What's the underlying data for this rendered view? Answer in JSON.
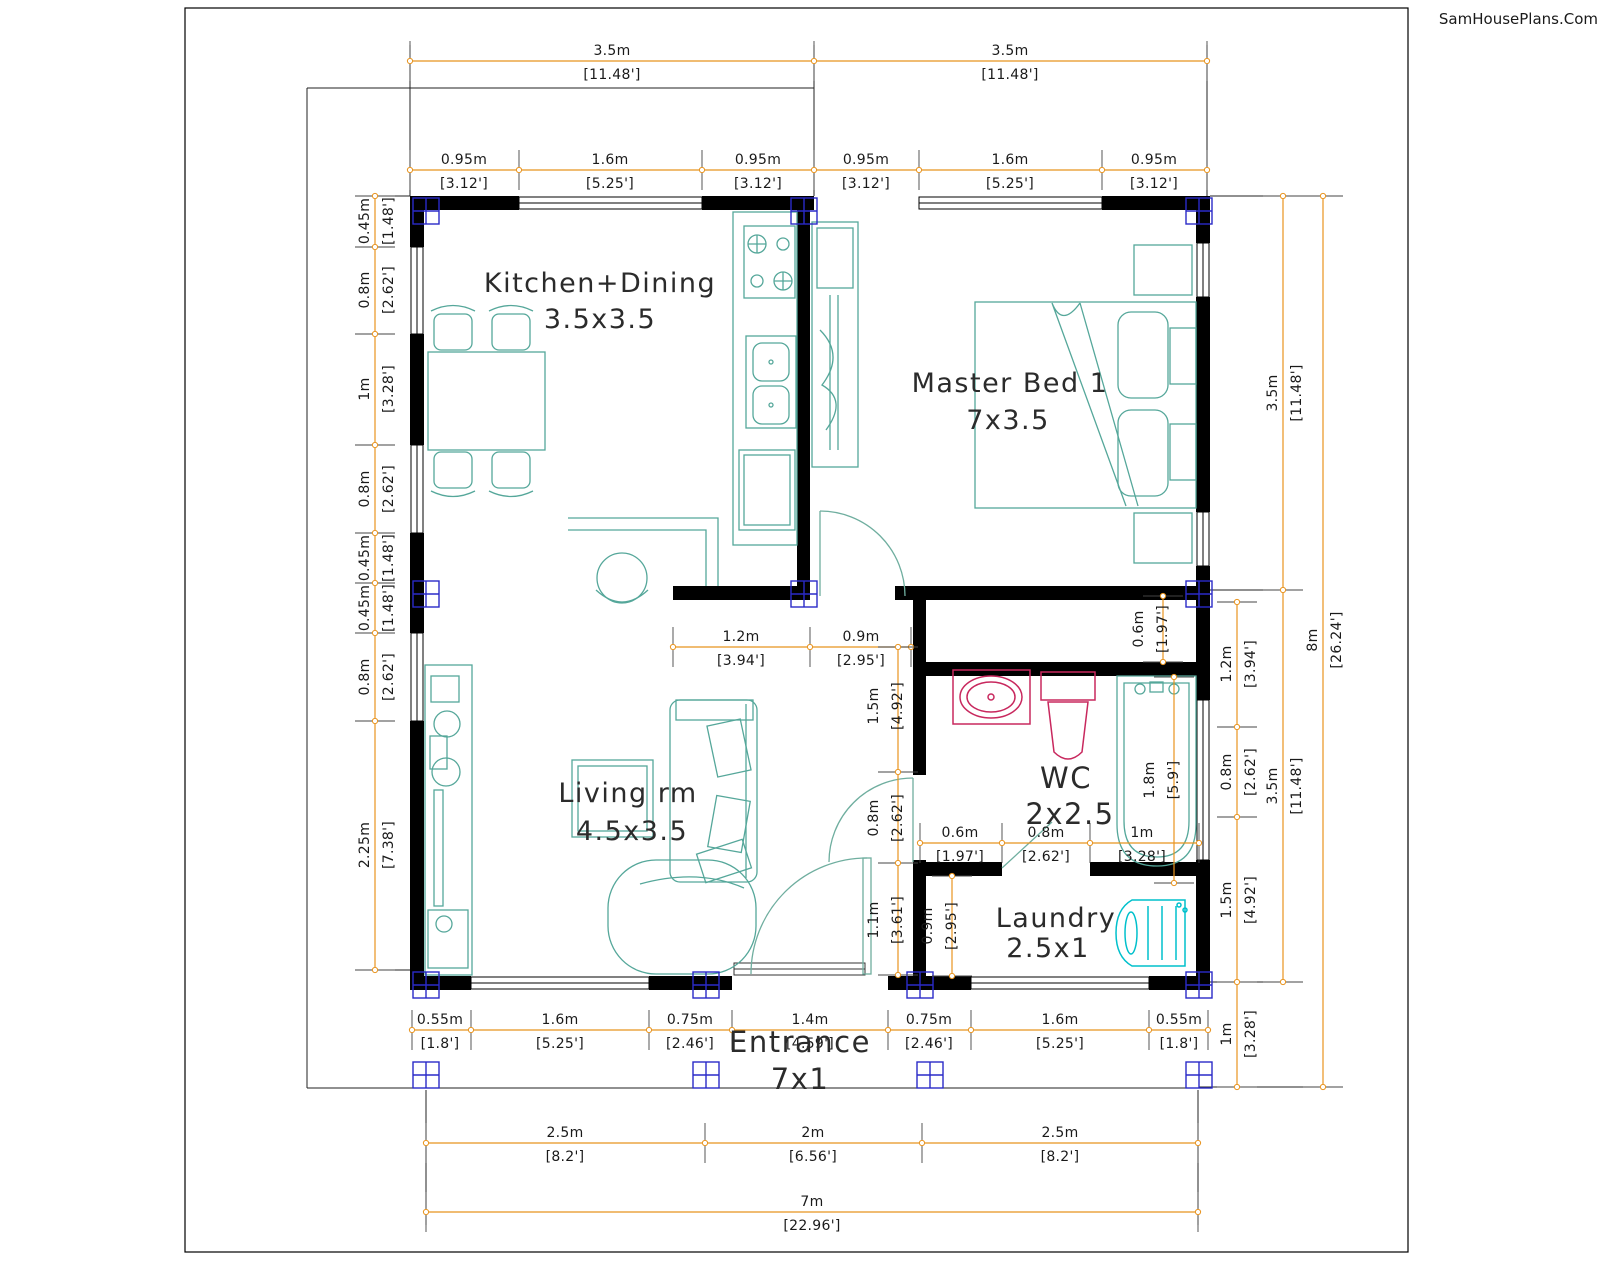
{
  "watermark": "SamHousePlans.Com",
  "colors": {
    "dim_line": "#E8941F",
    "wall": "#000000",
    "furniture": "#55A79A",
    "sanitary": "#C8285E",
    "washer": "#00C0CC",
    "column": "#2A2AC8",
    "tick": "#444444"
  },
  "rooms": [
    {
      "label": "Kitchen+Dining",
      "size": "3.5x3.5",
      "x": 600,
      "y": 292,
      "sx": 600,
      "sy": 328,
      "fs": 27
    },
    {
      "label": "Master Bed 1",
      "size": "7x3.5",
      "x": 1010,
      "y": 392,
      "sx": 1008,
      "sy": 429,
      "fs": 27
    },
    {
      "label": "Living rm",
      "size": "4.5x3.5",
      "x": 628,
      "y": 802,
      "sx": 632,
      "sy": 840,
      "fs": 27
    },
    {
      "label": "WC",
      "size": "2x2.5",
      "x": 1066,
      "y": 788,
      "sx": 1070,
      "sy": 824,
      "fs": 29
    },
    {
      "label": "Laundry",
      "size": "2.5x1",
      "x": 1056,
      "y": 927,
      "sx": 1048,
      "sy": 957,
      "fs": 27
    },
    {
      "label": "Entrance",
      "size": "7x1",
      "x": 800,
      "y": 1052,
      "sx": 800,
      "sy": 1089,
      "fs": 29
    }
  ],
  "dim_lines": [
    {
      "o": "h",
      "pos": 61,
      "from": 410,
      "to": 1207,
      "ticks": [
        410,
        814,
        1207
      ],
      "labels": [
        {
          "m": "3.5m",
          "ft": "[11.48']",
          "at": 612
        },
        {
          "m": "3.5m",
          "ft": "[11.48']",
          "at": 1010
        }
      ]
    },
    {
      "o": "h",
      "pos": 170,
      "from": 410,
      "to": 1207,
      "ticks": [
        410,
        519,
        702,
        814,
        919,
        1102,
        1207
      ],
      "labels": [
        {
          "m": "0.95m",
          "ft": "[3.12']",
          "at": 464
        },
        {
          "m": "1.6m",
          "ft": "[5.25']",
          "at": 610
        },
        {
          "m": "0.95m",
          "ft": "[3.12']",
          "at": 758
        },
        {
          "m": "0.95m",
          "ft": "[3.12']",
          "at": 866
        },
        {
          "m": "1.6m",
          "ft": "[5.25']",
          "at": 1010
        },
        {
          "m": "0.95m",
          "ft": "[3.12']",
          "at": 1154
        }
      ]
    },
    {
      "o": "h",
      "pos": 647,
      "from": 673,
      "to": 911,
      "ticks": [
        673,
        810,
        911
      ],
      "labels": [
        {
          "m": "1.2m",
          "ft": "[3.94']",
          "at": 741
        },
        {
          "m": "0.9m",
          "ft": "[2.95']",
          "at": 861
        }
      ]
    },
    {
      "o": "h",
      "pos": 843,
      "from": 920,
      "to": 1199,
      "ticks": [
        920,
        1002,
        1090,
        1199
      ],
      "labels": [
        {
          "m": "0.6m",
          "ft": "[1.97']",
          "at": 960
        },
        {
          "m": "0.8m",
          "ft": "[2.62']",
          "at": 1046
        },
        {
          "m": "1m",
          "ft": "[3.28']",
          "at": 1142
        }
      ]
    },
    {
      "o": "h",
      "pos": 1030,
      "from": 412,
      "to": 1208,
      "ticks": [
        412,
        471,
        649,
        732,
        888,
        971,
        1149,
        1208
      ],
      "labels": [
        {
          "m": "0.55m",
          "ft": "[1.8']",
          "at": 440
        },
        {
          "m": "1.6m",
          "ft": "[5.25']",
          "at": 560
        },
        {
          "m": "0.75m",
          "ft": "[2.46']",
          "at": 690
        },
        {
          "m": "1.4m",
          "ft": "[4.59']",
          "at": 810
        },
        {
          "m": "0.75m",
          "ft": "[2.46']",
          "at": 929
        },
        {
          "m": "1.6m",
          "ft": "[5.25']",
          "at": 1060
        },
        {
          "m": "0.55m",
          "ft": "[1.8']",
          "at": 1179
        }
      ]
    },
    {
      "o": "h",
      "pos": 1143,
      "from": 426,
      "to": 1198,
      "ticks": [
        426,
        705,
        922,
        1198
      ],
      "labels": [
        {
          "m": "2.5m",
          "ft": "[8.2']",
          "at": 565
        },
        {
          "m": "2m",
          "ft": "[6.56']",
          "at": 813
        },
        {
          "m": "2.5m",
          "ft": "[8.2']",
          "at": 1060
        }
      ]
    },
    {
      "o": "h",
      "pos": 1212,
      "from": 426,
      "to": 1198,
      "ticks": [
        426,
        1198
      ],
      "labels": [
        {
          "m": "7m",
          "ft": "[22.96']",
          "at": 812
        }
      ]
    },
    {
      "o": "v",
      "pos": 375,
      "from": 196,
      "to": 970,
      "ticks": [
        196,
        247,
        334,
        445,
        533,
        583,
        633,
        721,
        970
      ],
      "labels": [
        {
          "m": "0.45m",
          "ft": "[1.48']",
          "at": 221
        },
        {
          "m": "0.8m",
          "ft": "[2.62']",
          "at": 290
        },
        {
          "m": "1m",
          "ft": "[3.28']",
          "at": 389
        },
        {
          "m": "0.8m",
          "ft": "[2.62']",
          "at": 489
        },
        {
          "m": "0.45m",
          "ft": "[1.48']",
          "at": 558
        },
        {
          "m": "0.45m",
          "ft": "[1.48']",
          "at": 608
        },
        {
          "m": "0.8m",
          "ft": "[2.62']",
          "at": 677
        },
        {
          "m": "2.25m",
          "ft": "[7.38']",
          "at": 845
        }
      ]
    },
    {
      "o": "v",
      "pos": 1237,
      "from": 602,
      "to": 1087,
      "ticks": [
        602,
        727,
        817,
        982,
        1087
      ],
      "labels": [
        {
          "m": "1.2m",
          "ft": "[3.94']",
          "at": 664
        },
        {
          "m": "0.8m",
          "ft": "[2.62']",
          "at": 772
        },
        {
          "m": "1.5m",
          "ft": "[4.92']",
          "at": 900
        },
        {
          "m": "1m",
          "ft": "[3.28']",
          "at": 1034
        }
      ]
    },
    {
      "o": "v",
      "pos": 1283,
      "from": 196,
      "to": 982,
      "ticks": [
        196,
        590,
        982
      ],
      "labels": [
        {
          "m": "3.5m",
          "ft": "[11.48']",
          "at": 393
        },
        {
          "m": "3.5m",
          "ft": "[11.48']",
          "at": 786
        }
      ]
    },
    {
      "o": "v",
      "pos": 1323,
      "from": 196,
      "to": 1087,
      "ticks": [
        196,
        1087
      ],
      "labels": [
        {
          "m": "8m",
          "ft": "[26.24']",
          "at": 640
        }
      ]
    },
    {
      "o": "v",
      "pos": 1163,
      "from": 596,
      "to": 662,
      "ticks": [
        596,
        662
      ],
      "side": -1,
      "labels": [
        {
          "m": "0.6m",
          "ft": "[1.97']",
          "at": 629
        }
      ]
    },
    {
      "o": "v",
      "pos": 1174,
      "from": 677,
      "to": 883,
      "ticks": [
        677,
        883
      ],
      "side": -1,
      "labels": [
        {
          "m": "1.8m",
          "ft": "[5.9']",
          "at": 780
        }
      ]
    },
    {
      "o": "v",
      "pos": 898,
      "from": 647,
      "to": 975,
      "ticks": [
        647,
        772,
        863,
        975
      ],
      "side": -1,
      "labels": [
        {
          "m": "1.5m",
          "ft": "[4.92']",
          "at": 706
        },
        {
          "m": "0.8m",
          "ft": "[2.62']",
          "at": 818
        },
        {
          "m": "1.1m",
          "ft": "[3.61']",
          "at": 920
        }
      ]
    },
    {
      "o": "v",
      "pos": 952,
      "from": 876,
      "to": 976,
      "ticks": [
        876,
        976
      ],
      "side": -1,
      "labels": [
        {
          "m": "0.9m",
          "ft": "[2.95']",
          "at": 926
        }
      ]
    }
  ],
  "columns": [
    [
      426,
      211
    ],
    [
      804,
      211
    ],
    [
      1199,
      211
    ],
    [
      426,
      594
    ],
    [
      804,
      594
    ],
    [
      1199,
      594
    ],
    [
      426,
      985
    ],
    [
      706,
      985
    ],
    [
      920,
      985
    ],
    [
      1199,
      985
    ],
    [
      426,
      1075
    ],
    [
      706,
      1075
    ],
    [
      930,
      1075
    ],
    [
      1199,
      1075
    ]
  ]
}
